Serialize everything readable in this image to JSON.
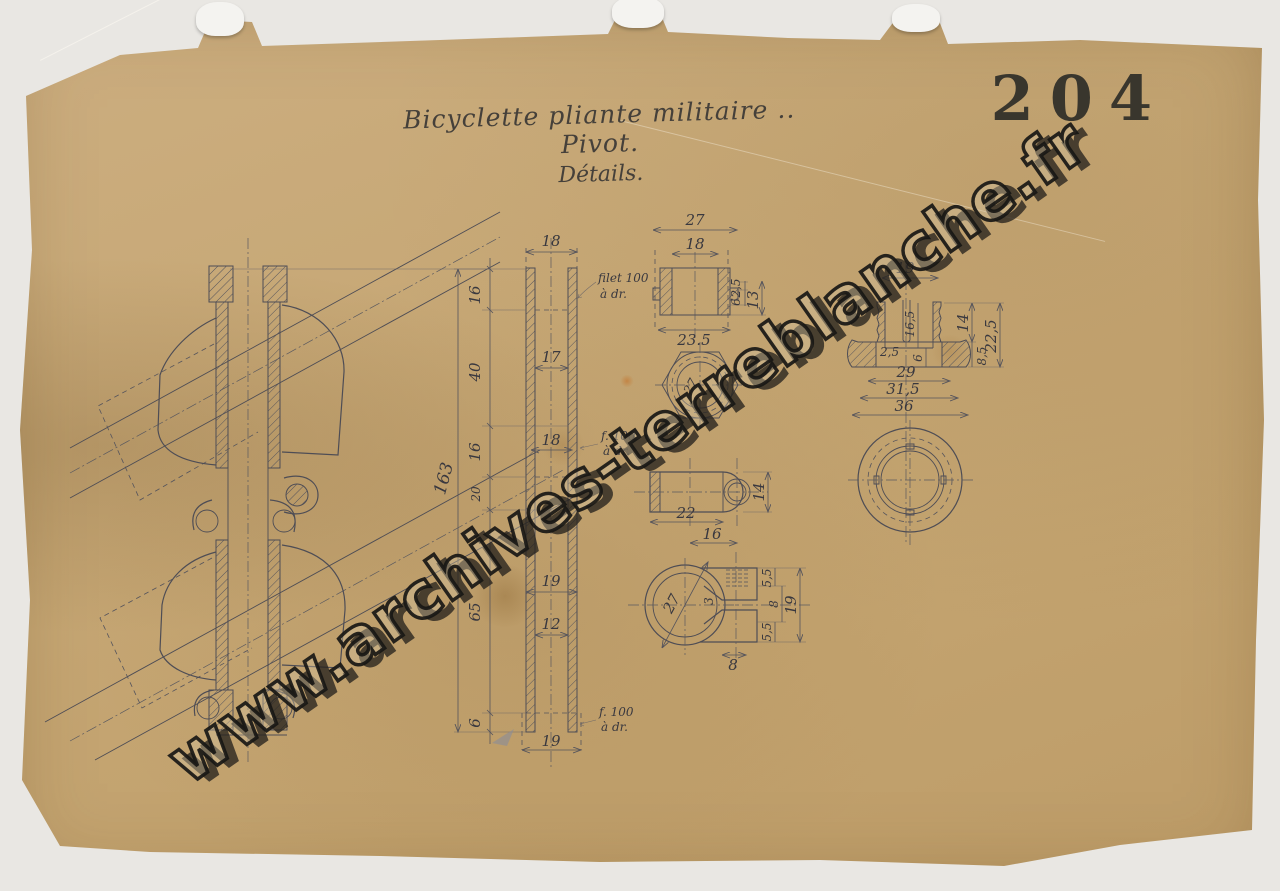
{
  "page": {
    "stamp_number": "204"
  },
  "title": {
    "line1": "Bicyclette pliante militaire .. Pivot.",
    "line2": "Détails."
  },
  "watermark": {
    "text": "www.archives-terreblanche.fr"
  },
  "colors": {
    "paper": "#c7a876",
    "ink": "#4e4d55",
    "stamp": "#2f2e29",
    "background": "#e9e7e3"
  },
  "drawing": {
    "column": {
      "top_width": "18",
      "seg_16a": "16",
      "seg_40": "40",
      "mid_17": "17",
      "seg_16b": "16",
      "mid_18": "18",
      "seg_20": "20",
      "seg_65": "65",
      "mid_19": "19",
      "mid_12": "12",
      "seg_6": "6",
      "bottom_width": "19",
      "overall": "163",
      "note1a": "filet 100",
      "note1b": "à dr.",
      "note2a": "f. 100",
      "note2b": "à dr.",
      "note3a": "f. 100",
      "note3b": "à dr."
    },
    "bushing": {
      "outer": "27",
      "inner": "18",
      "base": "23.5",
      "t_25": "2,5",
      "t_6": "6",
      "height": "13"
    },
    "hexnut": {
      "dia": "27"
    },
    "eyelug": {
      "length": "22",
      "to_center": "16",
      "height": "14"
    },
    "clamp": {
      "dia": "27",
      "slot": "3",
      "top": "5,5",
      "mid": "8",
      "bottom": "5,5",
      "overall": "19",
      "width": "8"
    },
    "cap": {
      "stem": "19",
      "depth": "16,5",
      "step": "6",
      "radius": "2,5",
      "d_29": "29",
      "d_315": "31,5",
      "d_36": "36",
      "flange": "8,5",
      "stem_h": "14",
      "overall": "22,5"
    }
  }
}
